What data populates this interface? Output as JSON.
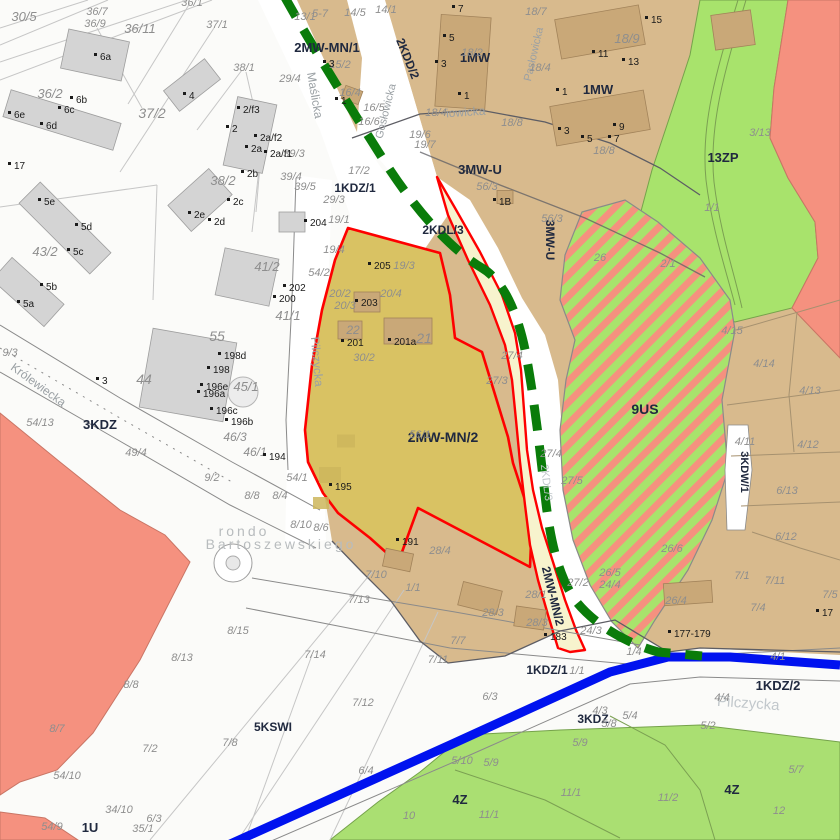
{
  "map": {
    "colors": {
      "zone_tan": "#d8ba8d",
      "zone_olive": "#d9c263",
      "zone_pale": "#f7f3cd",
      "zone_green": "#a8e36c",
      "zone_green_bottom": "#aadf72",
      "zone_salmon": "#f5917f",
      "road_white": "#ffffff",
      "boundary_red": "#fe0000",
      "line_blue": "#0012ef",
      "dash_green": "#0a7c0a",
      "building_fill": "#d4d4d4",
      "building_stroke": "#9e9e9e",
      "building_tan": "#c9a878",
      "building_tan_stroke": "#a2835a",
      "building_olive": "#cdb65c",
      "parcel_line": "#c6c6c6",
      "casing": "#8a8a8a",
      "dark_line": "#5d5d64",
      "tan_line": "#a6916f",
      "green_line": "#7ba052",
      "green_stroke": "#75a24b",
      "salmon_stroke": "#c97565",
      "hatch_stroke": "#8a8a8a",
      "label_zone": "#20293f",
      "label_parcel": "#8e8e8e",
      "label_building": "#1b1b1b",
      "label_street": "#9aa0a4",
      "label_faint": "#c2c8cc",
      "label_rondo": "#b8bcbe"
    },
    "labels": {
      "zones": [
        [
          "2MW-MN/1",
          327,
          52,
          0,
          13
        ],
        [
          "2KDD/2",
          404,
          60,
          68,
          12
        ],
        [
          "1MW",
          475,
          62,
          0,
          13
        ],
        [
          "1MW",
          598,
          94,
          0,
          13
        ],
        [
          "3MW-U",
          480,
          174,
          0,
          13
        ],
        [
          "2KDL/3",
          443,
          234,
          0,
          12
        ],
        [
          "3MW-U",
          546,
          240,
          90,
          12
        ],
        [
          "1KDZ/1",
          355,
          192,
          0,
          12
        ],
        [
          "13ZP",
          723,
          162,
          0,
          13
        ],
        [
          "9US",
          645,
          414,
          0,
          14
        ],
        [
          "3KDW/1",
          741,
          472,
          90,
          11
        ],
        [
          "2MW-MN/2",
          443,
          442,
          0,
          14
        ],
        [
          "3KDZ",
          100,
          429,
          0,
          13
        ],
        [
          "2MW-MN/2",
          549,
          597,
          76,
          12
        ],
        [
          "1KDZ/1",
          547,
          674,
          0,
          12
        ],
        [
          "1KDZ/2",
          778,
          690,
          0,
          13
        ],
        [
          "3KDZ",
          593,
          723,
          0,
          12
        ],
        [
          "5KSWI",
          273,
          731,
          0,
          12
        ],
        [
          "4Z",
          460,
          804,
          0,
          13
        ],
        [
          "4Z",
          732,
          794,
          0,
          13
        ],
        [
          "1U",
          90,
          832,
          0,
          13
        ]
      ],
      "streets": [
        [
          "Królewiecka",
          36,
          388,
          36,
          12,
          ""
        ],
        [
          "Maślicka",
          311,
          96,
          80,
          12,
          ""
        ],
        [
          "Pilczycka",
          313,
          362,
          85,
          12,
          ""
        ],
        [
          "Gosłowicka",
          389,
          112,
          -76,
          11,
          ""
        ],
        [
          "Pasłowicka",
          537,
          55,
          -77,
          11,
          ""
        ],
        [
          "iowicka",
          466,
          116,
          -4,
          12,
          ""
        ],
        [
          "Pilczycka",
          748,
          708,
          4,
          15,
          "faint"
        ],
        [
          "2KDL/3",
          543,
          483,
          83,
          11,
          "faint"
        ],
        [
          "rondo",
          244,
          536,
          0,
          14,
          "rondo"
        ],
        [
          "Bartoszewskiego",
          281,
          549,
          0,
          14,
          "rondo"
        ]
      ],
      "parcels": [
        [
          "30/5",
          24,
          21,
          13
        ],
        [
          "36/7",
          97,
          15
        ],
        [
          "36/9",
          95,
          27
        ],
        [
          "36/1",
          192,
          6
        ],
        [
          "37/1",
          217,
          28
        ],
        [
          "36/11",
          140,
          33,
          13
        ],
        [
          "36/2",
          50,
          98,
          13
        ],
        [
          "37/2",
          152,
          118,
          14
        ],
        [
          "38/1",
          244,
          71
        ],
        [
          "38/2",
          223,
          185,
          13
        ],
        [
          "39/3",
          294,
          157
        ],
        [
          "39/4",
          291,
          180
        ],
        [
          "39/5",
          305,
          190
        ],
        [
          "43/2",
          45,
          256,
          13
        ],
        [
          "44",
          144,
          384,
          14
        ],
        [
          "41/2",
          267,
          271,
          13
        ],
        [
          "41/1",
          288,
          320,
          13
        ],
        [
          "55",
          217,
          341,
          14
        ],
        [
          "45/1",
          246,
          391,
          13
        ],
        [
          "46/3",
          235,
          441,
          12
        ],
        [
          "46/1",
          255,
          456,
          12
        ],
        [
          "9/3",
          10,
          356
        ],
        [
          "9/2",
          212,
          481
        ],
        [
          "49/4",
          136,
          456
        ],
        [
          "54/13",
          40,
          426
        ],
        [
          "8/8",
          252,
          499
        ],
        [
          "8/4",
          280,
          499
        ],
        [
          "54/1",
          297,
          481
        ],
        [
          "54/2",
          319,
          276
        ],
        [
          "19/4",
          334,
          253
        ],
        [
          "19/1",
          339,
          223
        ],
        [
          "29/3",
          334,
          203
        ],
        [
          "29/4",
          290,
          82
        ],
        [
          "13/1",
          305,
          20
        ],
        [
          "5-7",
          320,
          17
        ],
        [
          "14/5",
          355,
          16
        ],
        [
          "14/1",
          386,
          13
        ],
        [
          "15/2",
          340,
          68
        ],
        [
          "16/4",
          350,
          96
        ],
        [
          "16/5",
          374,
          111
        ],
        [
          "16/6",
          369,
          125
        ],
        [
          "17/2",
          359,
          174
        ],
        [
          "19/6",
          420,
          138
        ],
        [
          "19/7",
          425,
          148
        ],
        [
          "18/2",
          472,
          56
        ],
        [
          "18/4",
          436,
          116
        ],
        [
          "18/4",
          540,
          71
        ],
        [
          "18/8",
          512,
          126
        ],
        [
          "18/8",
          604,
          154
        ],
        [
          "18/9",
          627,
          43,
          13
        ],
        [
          "18/7",
          536,
          15
        ],
        [
          "3/13",
          760,
          136
        ],
        [
          "1/1",
          712,
          211
        ],
        [
          "56/3",
          487,
          190
        ],
        [
          "56/3",
          552,
          222
        ],
        [
          "19/3",
          404,
          269
        ],
        [
          "20/2",
          340,
          297
        ],
        [
          "20/3",
          345,
          309
        ],
        [
          "20/4",
          391,
          297
        ],
        [
          "22",
          353,
          334,
          12
        ],
        [
          "21",
          424,
          343,
          14
        ],
        [
          "30/2",
          364,
          361
        ],
        [
          "27/3",
          497,
          384
        ],
        [
          "27/4",
          512,
          359
        ],
        [
          "27/4",
          551,
          457
        ],
        [
          "56/1",
          420,
          438
        ],
        [
          "28/4",
          440,
          554
        ],
        [
          "28/3",
          493,
          616
        ],
        [
          "28/3",
          537,
          626
        ],
        [
          "28/1",
          536,
          598
        ],
        [
          "1/1",
          413,
          591
        ],
        [
          "7/10",
          376,
          578
        ],
        [
          "7/13",
          359,
          603
        ],
        [
          "7/14",
          315,
          658
        ],
        [
          "7/12",
          363,
          706
        ],
        [
          "7/11",
          438,
          663
        ],
        [
          "7/7",
          458,
          644
        ],
        [
          "6/3",
          490,
          700
        ],
        [
          "6/4",
          366,
          774
        ],
        [
          "5/10",
          462,
          764
        ],
        [
          "5/9",
          491,
          766
        ],
        [
          "5/9",
          580,
          746
        ],
        [
          "10",
          409,
          819
        ],
        [
          "11/1",
          489,
          818
        ],
        [
          "11/1",
          571,
          796
        ],
        [
          "11/2",
          668,
          801
        ],
        [
          "12",
          779,
          814
        ],
        [
          "5/7",
          796,
          773
        ],
        [
          "5/2",
          708,
          729
        ],
        [
          "5/4",
          630,
          719
        ],
        [
          "5/8",
          609,
          727
        ],
        [
          "4/3",
          600,
          714
        ],
        [
          "4/4",
          722,
          701
        ],
        [
          "4/1",
          778,
          660
        ],
        [
          "1/4",
          634,
          655
        ],
        [
          "1/1",
          577,
          674
        ],
        [
          "24/3",
          591,
          634
        ],
        [
          "24/4",
          610,
          588
        ],
        [
          "27/2",
          578,
          586
        ],
        [
          "26/5",
          610,
          576
        ],
        [
          "26/4",
          676,
          604
        ],
        [
          "26/6",
          672,
          552
        ],
        [
          "27/5",
          572,
          484
        ],
        [
          "7/11",
          775,
          584
        ],
        [
          "7/5",
          830,
          598
        ],
        [
          "7/4",
          758,
          611
        ],
        [
          "7/1",
          742,
          579
        ],
        [
          "4/14",
          764,
          367
        ],
        [
          "4/13",
          810,
          394
        ],
        [
          "4/12",
          808,
          448
        ],
        [
          "4/11",
          745,
          445
        ],
        [
          "6/13",
          787,
          494
        ],
        [
          "6/12",
          786,
          540
        ],
        [
          "4/15",
          732,
          334
        ],
        [
          "8/15",
          238,
          634
        ],
        [
          "8/13",
          182,
          661
        ],
        [
          "7/2",
          150,
          752
        ],
        [
          "7/8",
          230,
          746
        ],
        [
          "54/10",
          67,
          779
        ],
        [
          "34/10",
          119,
          813
        ],
        [
          "6/3",
          154,
          822
        ],
        [
          "35/1",
          143,
          832
        ],
        [
          "54/9",
          52,
          830
        ],
        [
          "26",
          600,
          261
        ],
        [
          "2/1",
          668,
          267
        ],
        [
          "8/8",
          131,
          688
        ],
        [
          "8/7",
          57,
          732
        ],
        [
          "8/10",
          301,
          528
        ],
        [
          "8/6",
          321,
          531
        ]
      ],
      "buildings": [
        [
          "6a",
          100,
          60
        ],
        [
          "6b",
          76,
          103
        ],
        [
          "6c",
          64,
          113
        ],
        [
          "6d",
          46,
          129
        ],
        [
          "6e",
          14,
          118
        ],
        [
          "4",
          189,
          99
        ],
        [
          "2",
          232,
          132
        ],
        [
          "2/f3",
          243,
          113
        ],
        [
          "2a/f2",
          260,
          141
        ],
        [
          "2a",
          251,
          152
        ],
        [
          "2a/f1",
          270,
          157
        ],
        [
          "2b",
          247,
          177
        ],
        [
          "2c",
          233,
          205
        ],
        [
          "2e",
          194,
          218
        ],
        [
          "2d",
          214,
          225
        ],
        [
          "17",
          14,
          169
        ],
        [
          "5e",
          44,
          205
        ],
        [
          "5d",
          81,
          230
        ],
        [
          "5c",
          73,
          255
        ],
        [
          "5b",
          46,
          290
        ],
        [
          "5a",
          23,
          307
        ],
        [
          "3",
          102,
          384
        ],
        [
          "198d",
          224,
          359
        ],
        [
          "198",
          213,
          373
        ],
        [
          "196e",
          206,
          390
        ],
        [
          "196a",
          203,
          397
        ],
        [
          "196c",
          216,
          414
        ],
        [
          "196b",
          231,
          425
        ],
        [
          "204",
          310,
          226
        ],
        [
          "202",
          289,
          291
        ],
        [
          "200",
          279,
          302
        ],
        [
          "194",
          269,
          460
        ],
        [
          "195",
          335,
          490
        ],
        [
          "191",
          402,
          545
        ],
        [
          "205",
          374,
          269
        ],
        [
          "203",
          361,
          306
        ],
        [
          "201",
          347,
          346
        ],
        [
          "201a",
          394,
          345
        ],
        [
          "3",
          329,
          67
        ],
        [
          "1",
          341,
          104
        ],
        [
          "7",
          458,
          12
        ],
        [
          "5",
          449,
          41
        ],
        [
          "3",
          441,
          67
        ],
        [
          "1",
          464,
          99
        ],
        [
          "15",
          651,
          23
        ],
        [
          "11",
          598,
          57
        ],
        [
          "13",
          628,
          65
        ],
        [
          "9",
          619,
          130
        ],
        [
          "7",
          614,
          142
        ],
        [
          "5",
          587,
          142
        ],
        [
          "3",
          564,
          134
        ],
        [
          "1",
          562,
          95
        ],
        [
          "1B",
          499,
          205
        ],
        [
          "177-179",
          674,
          637
        ],
        [
          "183",
          550,
          640
        ],
        [
          "17",
          822,
          616
        ]
      ]
    }
  }
}
